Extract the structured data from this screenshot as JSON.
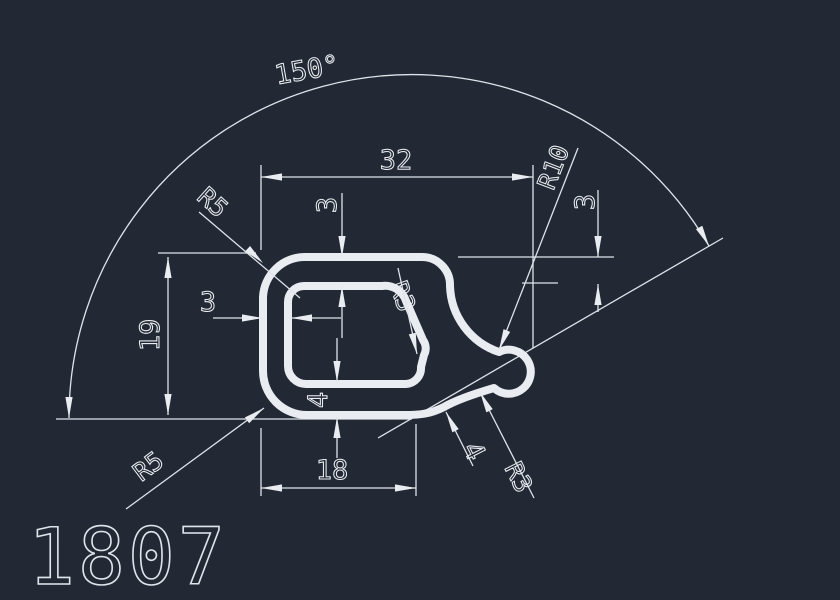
{
  "drawing": {
    "part_number": "1807",
    "background_color": "#222834",
    "line_color": "#e9ecf0",
    "labels": {
      "angle_150": "150°",
      "dim_width_overall": "32",
      "dim_height_overall": "19",
      "dim_bottom_flat": "18",
      "dim_wall_left": "3",
      "dim_wall_top": "3",
      "dim_wall_bottom": "4",
      "dim_drop_right": "3",
      "dim_tail_thickness": "4",
      "radius_top_corner": "R5",
      "radius_bottom_corner": "R5",
      "radius_inner_corner": "R3",
      "radius_hook": "R10",
      "radius_tail_fillet": "R3"
    }
  }
}
